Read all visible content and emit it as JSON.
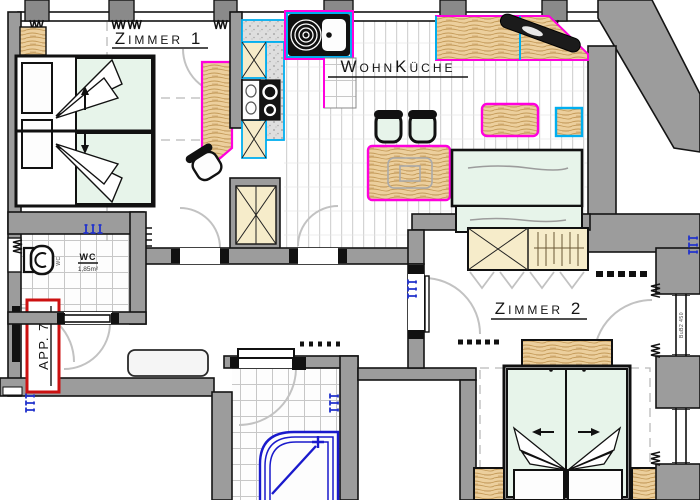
{
  "plan": {
    "apartment_label": "APP. 7",
    "rooms": {
      "zimmer1": {
        "label": "Zimmer 1"
      },
      "wohnkueche": {
        "label": "WohnKüche"
      },
      "zimmer2": {
        "label": "Zimmer 2"
      },
      "wc": {
        "label": "WC",
        "area": "1,85m²",
        "fixture": "WC"
      }
    },
    "window_tag": "BuB2 450",
    "colors": {
      "wall": "#9c9c9c",
      "wall_dark": "#8a8a8a",
      "line": "#141414",
      "mattress_green": "#e7f4ea",
      "wood": "#eccf9d",
      "cabinet_beige": "#f6ecca",
      "magenta": "#ff00dd",
      "cyan": "#00aeef",
      "plumbing_blue": "#2233cc",
      "apartment_red": "#cc1111",
      "door_arc_gray": "#c2c2c2"
    }
  }
}
